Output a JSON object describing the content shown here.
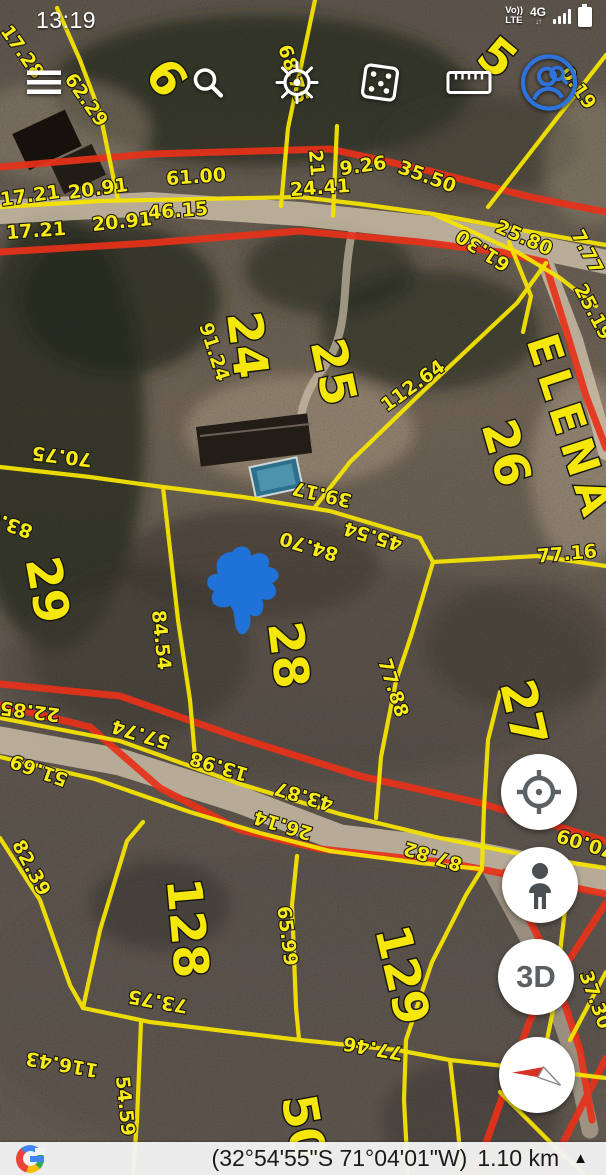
{
  "status_bar": {
    "time": "13:19",
    "volte_line1": "Vo))",
    "volte_line2": "LTE",
    "network": "4G",
    "data_arrows": "↓↑",
    "icons": [
      "signal-bars-icon",
      "battery-icon"
    ]
  },
  "toolbar": {
    "icons": [
      "menu-icon",
      "search-icon",
      "helm-icon",
      "dice-icon",
      "ruler-icon",
      "account-search-icon"
    ]
  },
  "fab": {
    "buttons": [
      "my-location",
      "street-view-pegman",
      "3d-toggle",
      "compass"
    ],
    "three_d_label": "3D"
  },
  "bottom_bar": {
    "google_logo": "G",
    "coordinates": "(32°54'55\"S 71°04'01\"W)",
    "scale": "1.10 km",
    "expand_icon": "▲"
  },
  "map": {
    "marker_color": "#1c76e3",
    "line_colors": {
      "parcel": "#f5e400",
      "road": "#e8311a"
    },
    "street_labels": [
      {
        "text": "ELENA",
        "x": 570,
        "y": 428,
        "rot": 72,
        "size": 44
      }
    ],
    "parcel_labels": [
      {
        "text": "24",
        "x": 247,
        "y": 345,
        "rot": 83
      },
      {
        "text": "25",
        "x": 333,
        "y": 372,
        "rot": 78
      },
      {
        "text": "26",
        "x": 506,
        "y": 453,
        "rot": 74
      },
      {
        "text": "29",
        "x": 47,
        "y": 590,
        "rot": 80
      },
      {
        "text": "28",
        "x": 288,
        "y": 655,
        "rot": 83
      },
      {
        "text": "27",
        "x": 523,
        "y": 713,
        "rot": 77
      },
      {
        "text": "128",
        "x": 187,
        "y": 928,
        "rot": 85
      },
      {
        "text": "129",
        "x": 402,
        "y": 975,
        "rot": 77
      },
      {
        "text": "50",
        "x": 303,
        "y": 1128,
        "rot": 80
      },
      {
        "text": "5",
        "x": 497,
        "y": 58,
        "rot": 40,
        "size": 42
      },
      {
        "text": "6",
        "x": 166,
        "y": 78,
        "rot": 55,
        "size": 36
      }
    ],
    "measurement_labels": [
      {
        "text": "17.28",
        "x": 22,
        "y": 52,
        "rot": 55
      },
      {
        "text": "62.29",
        "x": 86,
        "y": 100,
        "rot": 55
      },
      {
        "text": "68.75",
        "x": 293,
        "y": 74,
        "rot": 72
      },
      {
        "text": "0.19",
        "x": 578,
        "y": 88,
        "rot": 55
      },
      {
        "text": "17.21",
        "x": 30,
        "y": 196,
        "rot": -8
      },
      {
        "text": "20.91",
        "x": 98,
        "y": 189,
        "rot": -8
      },
      {
        "text": "61.00",
        "x": 196,
        "y": 177,
        "rot": -4
      },
      {
        "text": "46.15",
        "x": 178,
        "y": 211,
        "rot": -4
      },
      {
        "text": "17.21",
        "x": 36,
        "y": 231,
        "rot": -4
      },
      {
        "text": "20.91",
        "x": 122,
        "y": 222,
        "rot": -6
      },
      {
        "text": "24.41",
        "x": 320,
        "y": 188,
        "rot": -4
      },
      {
        "text": "9.26",
        "x": 363,
        "y": 166,
        "rot": -8,
        "size": 23
      },
      {
        "text": "21",
        "x": 316,
        "y": 163,
        "rot": 85,
        "size": 14
      },
      {
        "text": "35.50",
        "x": 427,
        "y": 177,
        "rot": 20
      },
      {
        "text": "25.80",
        "x": 524,
        "y": 238,
        "rot": 24
      },
      {
        "text": "61.30",
        "x": 483,
        "y": 250,
        "rot": 213
      },
      {
        "text": "7.77",
        "x": 587,
        "y": 252,
        "rot": 62
      },
      {
        "text": "25.19",
        "x": 593,
        "y": 312,
        "rot": 62
      },
      {
        "text": "91.24",
        "x": 214,
        "y": 352,
        "rot": 72
      },
      {
        "text": "112.64",
        "x": 413,
        "y": 386,
        "rot": -36
      },
      {
        "text": "70.75",
        "x": 62,
        "y": 456,
        "rot": 187
      },
      {
        "text": "83.0",
        "x": 10,
        "y": 524,
        "rot": 200
      },
      {
        "text": "39.17",
        "x": 322,
        "y": 494,
        "rot": 193
      },
      {
        "text": "84.70",
        "x": 309,
        "y": 546,
        "rot": 197
      },
      {
        "text": "45.54",
        "x": 373,
        "y": 536,
        "rot": 197
      },
      {
        "text": "77.16",
        "x": 567,
        "y": 554,
        "rot": -5
      },
      {
        "text": "84.54",
        "x": 161,
        "y": 640,
        "rot": 84
      },
      {
        "text": "77.88",
        "x": 393,
        "y": 688,
        "rot": 72
      },
      {
        "text": "22.85",
        "x": 30,
        "y": 711,
        "rot": 187
      },
      {
        "text": "57.74",
        "x": 141,
        "y": 734,
        "rot": 197
      },
      {
        "text": "51.69",
        "x": 39,
        "y": 770,
        "rot": 200
      },
      {
        "text": "13.98",
        "x": 219,
        "y": 766,
        "rot": 197
      },
      {
        "text": "43.87",
        "x": 304,
        "y": 796,
        "rot": 197
      },
      {
        "text": "26.14",
        "x": 283,
        "y": 825,
        "rot": 197
      },
      {
        "text": "87.82",
        "x": 433,
        "y": 856,
        "rot": 197
      },
      {
        "text": "70.09",
        "x": 586,
        "y": 843,
        "rot": 197
      },
      {
        "text": "82.39",
        "x": 31,
        "y": 868,
        "rot": 62
      },
      {
        "text": "65.99",
        "x": 287,
        "y": 936,
        "rot": 83
      },
      {
        "text": "73.75",
        "x": 158,
        "y": 1001,
        "rot": 190
      },
      {
        "text": "77.46",
        "x": 373,
        "y": 1048,
        "rot": 190
      },
      {
        "text": "116.43",
        "x": 62,
        "y": 1064,
        "rot": 190
      },
      {
        "text": "54.59",
        "x": 125,
        "y": 1106,
        "rot": 84
      },
      {
        "text": "37.30",
        "x": 595,
        "y": 1000,
        "rot": 70
      }
    ]
  }
}
